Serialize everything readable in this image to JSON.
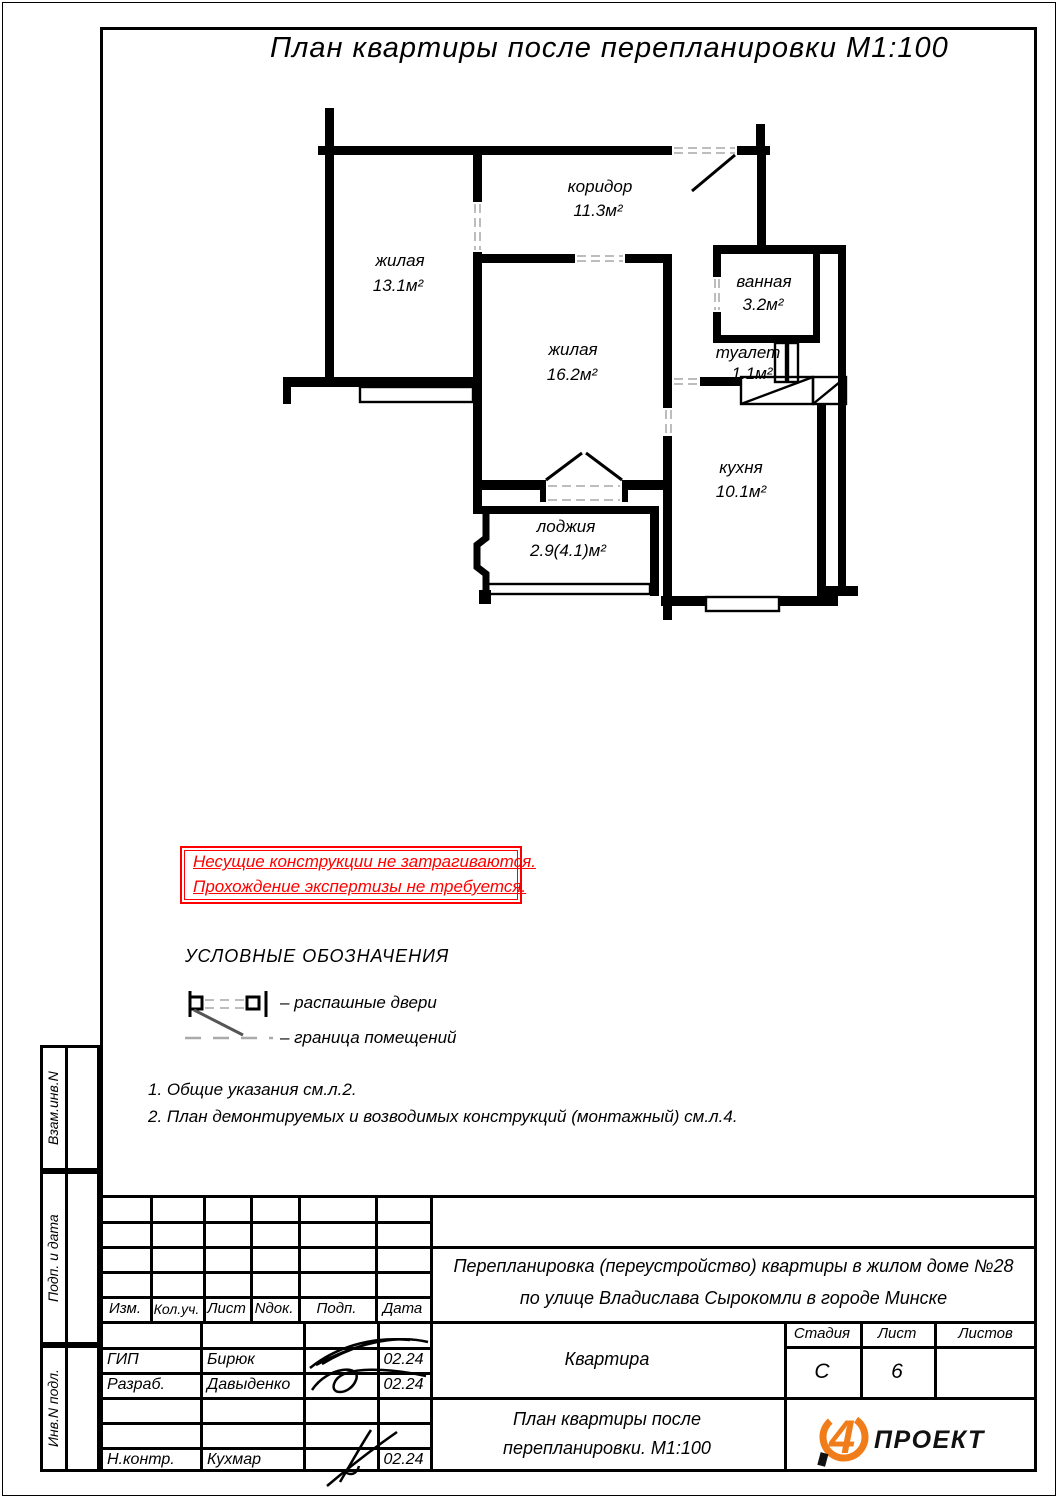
{
  "page": {
    "title": "План квартиры после перепланировки М1:100"
  },
  "plan": {
    "rooms": [
      {
        "name": "жилая",
        "area": "13.1м²"
      },
      {
        "name": "коридор",
        "area": "11.3м²"
      },
      {
        "name": "ванная",
        "area": "3.2м²"
      },
      {
        "name": "туалет",
        "area": "1.1м²"
      },
      {
        "name": "жилая",
        "area": "16.2м²"
      },
      {
        "name": "кухня",
        "area": "10.1м²"
      },
      {
        "name": "лоджия",
        "area": "2.9(4.1)м²"
      }
    ]
  },
  "warning": {
    "line1": "Несущие конструкции не затрагиваются.",
    "line2": "Прохождение экспертизы не требуется.",
    "color": "#ff0000"
  },
  "legend": {
    "title": "УСЛОВНЫЕ ОБОЗНАЧЕНИЯ",
    "items": [
      {
        "label": "– распашные двери"
      },
      {
        "label": "– граница помещений"
      }
    ]
  },
  "notes": [
    "1. Общие указания см.л.2.",
    "2. План демонтируемых и возводимых конструкций (монтажный) см.л.4."
  ],
  "sidebar": {
    "labels": [
      "Взам.инв.N",
      "Подп. и дата",
      "Инв.N подл."
    ]
  },
  "titleblock": {
    "header_cols": [
      "Изм.",
      "Кол.уч.",
      "Лист",
      "Nдок.",
      "Подп.",
      "Дата"
    ],
    "staff": [
      {
        "role": "ГИП",
        "name": "Бирюк",
        "date": "02.24"
      },
      {
        "role": "Разраб.",
        "name": "Давыденко",
        "date": "02.24"
      },
      {
        "role": "Н.контр.",
        "name": "Кухмар",
        "date": "02.24"
      }
    ],
    "project_line1": "Перепланировка (переустройство) квартиры в жилом доме №28",
    "project_line2": "по улице Владислава Сырокомли в городе Минске",
    "object": "Квартира",
    "stage_label": "Стадия",
    "stage": "С",
    "sheet_label": "Лист",
    "sheet": "6",
    "sheets_label": "Листов",
    "sheets": "",
    "drawing_title_line1": "План квартиры после",
    "drawing_title_line2": "перепланировки. М1:100",
    "logo_text": "ПРОЕКТ",
    "logo_color": "#F07D1A"
  }
}
